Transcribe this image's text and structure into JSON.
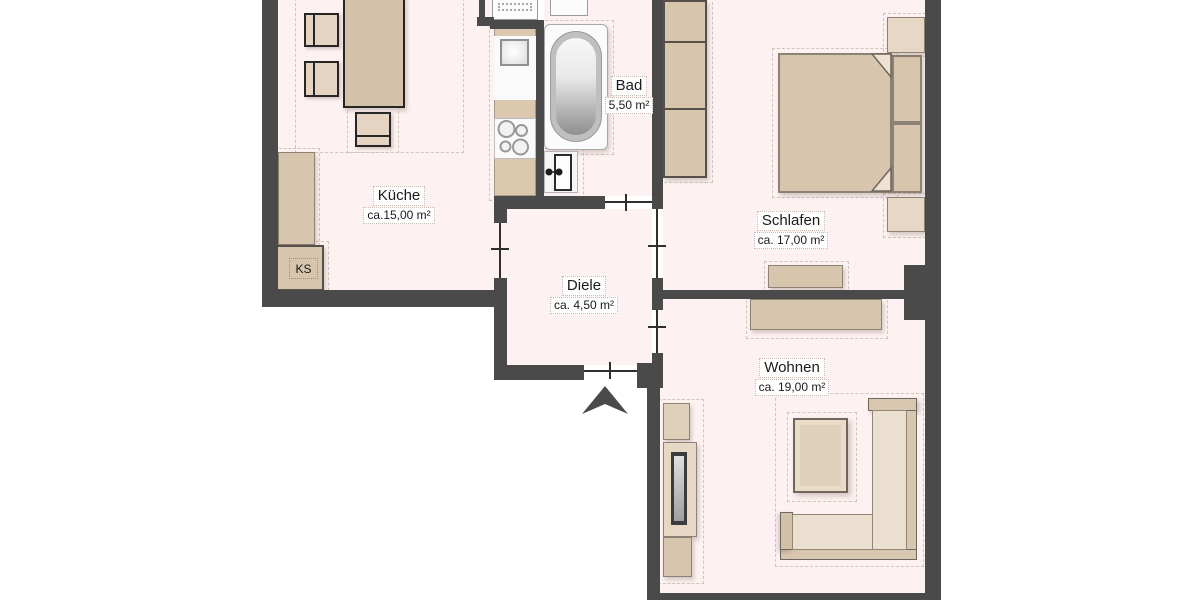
{
  "floor_plan": {
    "rooms": [
      {
        "id": "kueche",
        "name": "Küche",
        "area": "ca.15,00 m²"
      },
      {
        "id": "bad",
        "name": "Bad",
        "area": "5,50 m²"
      },
      {
        "id": "schlafen",
        "name": "Schlafen",
        "area": "ca. 17,00 m²"
      },
      {
        "id": "diele",
        "name": "Diele",
        "area": "ca. 4,50 m²"
      },
      {
        "id": "wohnen",
        "name": "Wohnen",
        "area": "ca. 19,00 m²"
      }
    ],
    "fridge_label": "KS",
    "colors": {
      "wall": "#4a4a4a",
      "floor": "#fdf2f1",
      "furniture": "#d8c5ad",
      "furniture_light": "#e9dccb",
      "background": "#ffffff"
    }
  }
}
